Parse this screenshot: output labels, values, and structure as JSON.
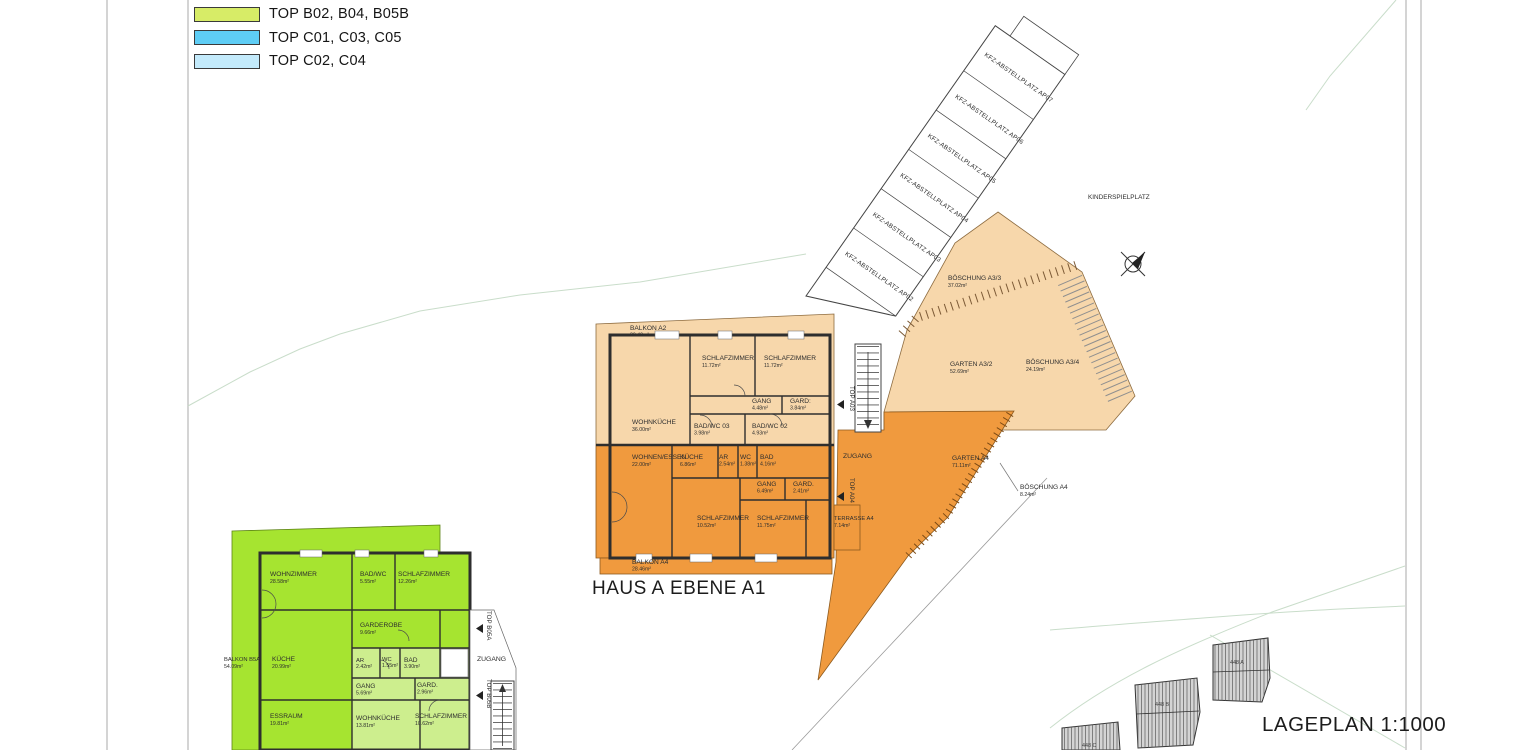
{
  "colors": {
    "peach": "#f7d7ab",
    "orange": "#f09a3e",
    "bright_green": "#a6e430",
    "light_green": "#cdee8e",
    "legend_green": "#d7ec67",
    "legend_blue": "#5ecdf5",
    "legend_light_blue": "#c3eafb",
    "wall": "#2e2e2e",
    "contour_green": "#c9ddca"
  },
  "legend": {
    "items": [
      {
        "label": "TOP B02, B04, B05B",
        "color": "#d7ec67"
      },
      {
        "label": "TOP C01, C03, C05",
        "color": "#5ecdf5"
      },
      {
        "label": "TOP C02, C04",
        "color": "#c3eafb"
      }
    ]
  },
  "labels": {
    "kinderspielplatz": "KINDERSPIELPLATZ",
    "haus": "HAUS A",
    "ebene": "EBENE A1",
    "lageplan": "LAGEPLAN 1:1000"
  },
  "parking": {
    "stalls": [
      "KFZ-ABSTELLPLATZ AP02",
      "KFZ-ABSTELLPLATZ AP03",
      "KFZ-ABSTELLPLATZ AP04",
      "KFZ-ABSTELLPLATZ AP05",
      "KFZ-ABSTELLPLATZ AP06",
      "KFZ-ABSTELLPLATZ AP07"
    ]
  },
  "outdoor": {
    "boeschung_a33": {
      "name": "BÖSCHUNG A3/3",
      "area": "37.02m²"
    },
    "garten_a32": {
      "name": "GARTEN A3/2",
      "area": "52.69m²"
    },
    "boeschung_a34": {
      "name": "BÖSCHUNG A3/4",
      "area": "24.19m²"
    },
    "garten_a4": {
      "name": "GARTEN A4",
      "area": "71.11m²"
    },
    "boeschung_a4": {
      "name": "BÖSCHUNG A4",
      "area": "8.24m²"
    }
  },
  "haus_a": {
    "top_a03": "TOP A03",
    "top_a04": "TOP A04",
    "zugang": "ZUGANG",
    "balkon_a2": {
      "name": "BALKON A2",
      "area": "30.40m²"
    },
    "balkon_a4": {
      "name": "BALKON A4",
      "area": "28.46m²"
    },
    "terrasse_a4": {
      "name": "TERRASSE A4",
      "area": "7.14m²"
    },
    "a03_rooms": [
      {
        "name": "SCHLAFZIMMER",
        "area": "11.72m²"
      },
      {
        "name": "SCHLAFZIMMER",
        "area": "11.72m²"
      },
      {
        "name": "GANG",
        "area": "4.48m²"
      },
      {
        "name": "GARD:",
        "area": "3.84m²"
      },
      {
        "name": "WOHNKÜCHE",
        "area": "36.00m²"
      },
      {
        "name": "BAD/WC 03",
        "area": "3.98m²"
      },
      {
        "name": "BAD/WC 02",
        "area": "4.93m²"
      }
    ],
    "a04_rooms": [
      {
        "name": "WOHNEN/ESSEN",
        "area": "22.00m²"
      },
      {
        "name": "KÜCHE",
        "area": "6.86m²"
      },
      {
        "name": "AR",
        "area": "2.54m²"
      },
      {
        "name": "WC",
        "area": "1.38m²"
      },
      {
        "name": "BAD",
        "area": "4.16m²"
      },
      {
        "name": "GANG",
        "area": "6.49m²"
      },
      {
        "name": "GARD.",
        "area": "2.41m²"
      },
      {
        "name": "SCHLAFZIMMER",
        "area": "10.52m²"
      },
      {
        "name": "SCHLAFZIMMER",
        "area": "11.75m²"
      }
    ]
  },
  "haus_b": {
    "top_b05a": "TOP B05A",
    "top_b05b": "TOP B05B",
    "zugang": "ZUGANG",
    "balkon_b5a": {
      "name": "BALKON B5A",
      "area": "54.09m²"
    },
    "b05a_rooms": [
      {
        "name": "WOHNZIMMER",
        "area": "28.58m²"
      },
      {
        "name": "BAD/WC",
        "area": "5.55m²"
      },
      {
        "name": "SCHLAFZIMMER",
        "area": "12.26m²"
      },
      {
        "name": "GARDEROBE",
        "area": "9.66m²"
      },
      {
        "name": "KÜCHE",
        "area": "20.99m²"
      },
      {
        "name": "ESSRAUM",
        "area": "19.81m²"
      }
    ],
    "b05b_rooms": [
      {
        "name": "AR",
        "area": "2.42m²"
      },
      {
        "name": "WC",
        "area": "1.55m²"
      },
      {
        "name": "BAD",
        "area": "3.90m²"
      },
      {
        "name": "GANG",
        "area": "5.69m²"
      },
      {
        "name": "GARD.",
        "area": "2.96m²"
      },
      {
        "name": "WOHNKÜCHE",
        "area": "13.81m²"
      },
      {
        "name": "SCHLAFZIMMER",
        "area": "10.62m²"
      }
    ]
  },
  "neighbors": {
    "buildings": [
      "448 A",
      "448 B",
      "448 C"
    ]
  }
}
